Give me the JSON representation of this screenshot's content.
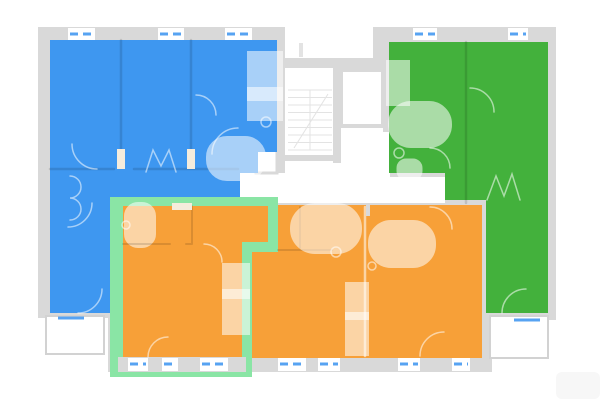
{
  "meta": {
    "view": "building-floor-plan",
    "canvas": {
      "w": 600,
      "h": 401
    }
  },
  "palette": {
    "bg": "#ffffff",
    "wall": "#d9d9d9",
    "stair": "#e3e3e3",
    "window": "#57a3f2",
    "balcony_stroke": "#d2d2d2",
    "terrace": "#f7f7f7",
    "blue": "#3e97f0",
    "green": "#43b13c",
    "orange": "#f7a038",
    "highlight": "#8ae5a5",
    "sill": "#f5ecdc",
    "door_white": "#ffffff"
  },
  "plan": {
    "footprint": "M38,27 L285,27 L285,58 L373,58 L373,27 L556,27 L556,320 L492,320 L492,372 L108,372 L108,318 L38,318 Z",
    "terrace": {
      "x": 556,
      "y": 372,
      "w": 44,
      "h": 27,
      "rx": 6
    },
    "corridor": "M285,68 L390,68 L390,177 L445,177 L445,203 L240,203 L240,173 L285,173 Z",
    "stairs": {
      "x1": 288,
      "x2": 332,
      "ytop": 90,
      "ybot": 150,
      "step": 7.5,
      "mid": 310,
      "diag": "M294,148 L328,94",
      "sep_wall": {
        "x": 333,
        "y": 68,
        "w": 8,
        "h": 95
      },
      "under_wall": {
        "x": 285,
        "y": 155,
        "w": 56,
        "h": 6
      },
      "right_wall": {
        "x": 383,
        "y": 68,
        "w": 7,
        "h": 64
      }
    },
    "elevator": {
      "x": 341,
      "y": 70,
      "w": 42,
      "h": 56
    },
    "shaft": {
      "x": 256,
      "y": 150,
      "w": 21,
      "h": 23
    },
    "units": [
      {
        "id": "apartment-unit-blue",
        "color": "#3e97f0",
        "highlighted": false,
        "points": "50,40 277,40 277,152 258,152 258,173 240,173 240,199 113,199 113,313 50,313"
      },
      {
        "id": "apartment-unit-green",
        "color": "#43b13c",
        "highlighted": false,
        "points": "389,42 548,42 548,313 486,313 486,200 445,200 445,173 389,173"
      },
      {
        "id": "apartment-unit-orange-right",
        "color": "#f7a038",
        "highlighted": false,
        "points": "278,205 482,205 482,358 252,358 252,252 278,252"
      },
      {
        "id": "apartment-unit-orange-selected",
        "color": "#f7a038",
        "highlighted": true,
        "highlight_color": "#8ae5a5",
        "outline_points": "110,197 278,197 278,252 252,252 252,377 110,377",
        "points": "123,206 268,206 268,242 242,242 242,357 123,357"
      }
    ],
    "rewall": {
      "x": 118,
      "y": 357,
      "w": 128,
      "h": 15
    },
    "windows": {
      "top": {
        "y": 28,
        "h": 12,
        "ly": 34,
        "items": [
          {
            "x": 68,
            "w": 27
          },
          {
            "x": 158,
            "w": 26
          },
          {
            "x": 225,
            "w": 27
          },
          {
            "x": 413,
            "w": 24
          },
          {
            "x": 508,
            "w": 20
          }
        ]
      },
      "bottom": {
        "y": 358,
        "h": 13,
        "ly": 364,
        "items": [
          {
            "x": 128,
            "w": 20
          },
          {
            "x": 162,
            "w": 16
          },
          {
            "x": 200,
            "w": 28
          },
          {
            "x": 278,
            "w": 28
          },
          {
            "x": 318,
            "w": 22
          },
          {
            "x": 398,
            "w": 22
          },
          {
            "x": 452,
            "w": 18
          }
        ]
      }
    },
    "balconies": [
      {
        "x": 46,
        "y": 316,
        "w": 58,
        "h": 38,
        "line": {
          "x1": 58,
          "x2": 84,
          "y": 318
        }
      },
      {
        "x": 490,
        "y": 316,
        "w": 58,
        "h": 42,
        "line": {
          "x1": 514,
          "x2": 540,
          "y": 320
        }
      }
    ],
    "fixtures": [
      {
        "k": "p",
        "d": "M121,40 L121,167",
        "s": "K",
        "w": 2.5
      },
      {
        "k": "p",
        "d": "M191,40 L191,167",
        "s": "K",
        "w": 2.5
      },
      {
        "k": "p",
        "d": "M50,169 L114,169 M134,169 L238,169",
        "s": "K",
        "w": 2.5
      },
      {
        "k": "r",
        "x": 117,
        "y": 149,
        "w": 8,
        "h": 20,
        "f": "C"
      },
      {
        "k": "r",
        "x": 187,
        "y": 149,
        "w": 8,
        "h": 20,
        "f": "C"
      },
      {
        "k": "r",
        "x": 256,
        "y": 60,
        "w": 18,
        "h": 32,
        "s": "W"
      },
      {
        "k": "r",
        "x": 256,
        "y": 96,
        "w": 18,
        "h": 16,
        "s": "W"
      },
      {
        "k": "c",
        "cx": 266,
        "cy": 122,
        "r": 5,
        "s": "W"
      },
      {
        "k": "r",
        "x": 221,
        "y": 151,
        "w": 30,
        "h": 15,
        "rx": 6,
        "s": "W"
      },
      {
        "k": "p",
        "d": "M146,172 L153,150 L161,166 L169,150 L176,172",
        "s": "W"
      },
      {
        "k": "p",
        "d": "M97,169 A25,25 0 0 1 72,144",
        "s": "W"
      },
      {
        "k": "p",
        "d": "M196,95 A20,20 0 0 1 216,115",
        "s": "W"
      },
      {
        "k": "p",
        "d": "M238,128 A26,26 0 0 0 212,154",
        "s": "W"
      },
      {
        "k": "p",
        "d": "M92,203 A24,24 0 0 1 68,227",
        "s": "W"
      },
      {
        "k": "p",
        "d": "M70,176 a11,11 0 1 1 0,22 a11,11 0 1 1 0,22",
        "s": "W"
      },
      {
        "k": "p",
        "d": "M78,313 A24,24 0 0 0 102,289",
        "s": "W"
      },
      {
        "k": "p",
        "d": "M466,42 L466,203",
        "s": "K",
        "w": 2.5
      },
      {
        "k": "r",
        "x": 404,
        "y": 117,
        "w": 32,
        "h": 15,
        "rx": 7,
        "s": "W"
      },
      {
        "k": "c",
        "cx": 399,
        "cy": 153,
        "r": 5,
        "s": "W"
      },
      {
        "k": "r",
        "x": 403,
        "y": 165,
        "w": 13,
        "h": 9,
        "rx": 3,
        "s": "W"
      },
      {
        "k": "r",
        "x": 392,
        "y": 66,
        "w": 12,
        "h": 34,
        "s": "W"
      },
      {
        "k": "p",
        "d": "M470,88 A24,24 0 0 1 494,112",
        "s": "W"
      },
      {
        "k": "p",
        "d": "M430,148 A20,20 0 0 1 450,168",
        "s": "W"
      },
      {
        "k": "p",
        "d": "M487,200 L496,176 L504,196 L512,174 L520,200",
        "s": "W"
      },
      {
        "k": "p",
        "d": "M502,313 A24,24 0 0 1 526,289",
        "s": "W"
      },
      {
        "k": "r",
        "x": 132,
        "y": 210,
        "w": 16,
        "h": 30,
        "rx": 6,
        "s": "W"
      },
      {
        "k": "c",
        "cx": 126,
        "cy": 225,
        "r": 4,
        "s": "W"
      },
      {
        "k": "p",
        "d": "M123,244 L170,244 M186,244 L192,244 M192,206 L192,244",
        "s": "K",
        "w": 2
      },
      {
        "k": "r",
        "x": 172,
        "y": 203,
        "w": 20,
        "h": 7,
        "f": "C"
      },
      {
        "k": "r",
        "x": 229,
        "y": 270,
        "w": 14,
        "h": 22,
        "s": "W"
      },
      {
        "k": "r",
        "x": 229,
        "y": 296,
        "w": 14,
        "h": 32,
        "s": "W"
      },
      {
        "k": "p",
        "d": "M148,357 A20,20 0 0 1 168,337",
        "s": "W"
      },
      {
        "k": "p",
        "d": "M204,244 A18,18 0 0 1 222,262",
        "s": "W"
      },
      {
        "k": "p",
        "d": "M365,207 L365,356",
        "s": "W",
        "w": 2.5
      },
      {
        "k": "p",
        "d": "M300,207 L300,248 M278,250 L332,250",
        "s": "K",
        "w": 2
      },
      {
        "k": "r",
        "x": 308,
        "y": 221,
        "w": 36,
        "h": 15,
        "rx": 7,
        "s": "W"
      },
      {
        "k": "r",
        "x": 385,
        "y": 237,
        "w": 34,
        "h": 14,
        "rx": 6,
        "s": "W"
      },
      {
        "k": "c",
        "cx": 336,
        "cy": 252,
        "r": 5,
        "s": "W"
      },
      {
        "k": "c",
        "cx": 372,
        "cy": 266,
        "r": 4,
        "s": "W"
      },
      {
        "k": "r",
        "x": 351,
        "y": 288,
        "w": 12,
        "h": 26,
        "s": "W"
      },
      {
        "k": "r",
        "x": 351,
        "y": 318,
        "w": 12,
        "h": 32,
        "s": "W"
      },
      {
        "k": "p",
        "d": "M430,207 A22,22 0 0 1 452,229",
        "s": "W"
      },
      {
        "k": "p",
        "d": "M420,356 A24,24 0 0 1 444,332",
        "s": "W"
      },
      {
        "k": "r",
        "x": 367,
        "y": 205,
        "w": 2,
        "h": 10,
        "f": "#ffffff",
        "s": "G"
      },
      {
        "k": "r",
        "x": 300,
        "y": 44,
        "w": 2,
        "h": 12,
        "f": "#ffffff",
        "s": "#e3e3e3"
      }
    ]
  }
}
